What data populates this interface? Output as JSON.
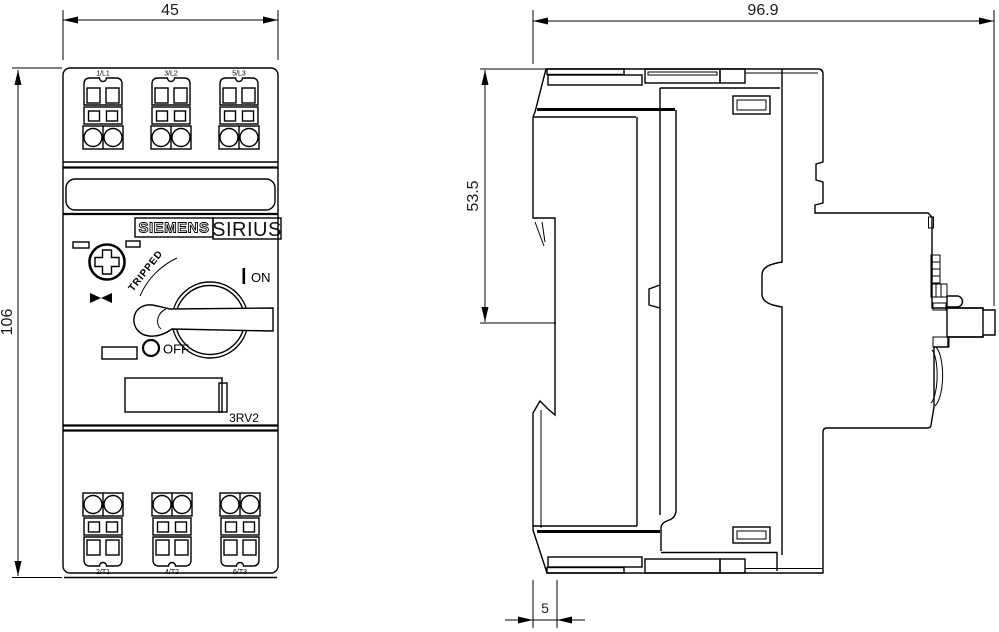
{
  "title": "Dimensional drawing motor starter protector",
  "dimensions": {
    "front_width": "45",
    "front_height": "106",
    "side_depth": "96.9",
    "side_upper": "53.5",
    "side_offset": "5"
  },
  "branding": {
    "logo": "SIEMENS",
    "series": "SIRIUS",
    "model": "3RV2"
  },
  "controls": {
    "tripped_label": "TRIPPED",
    "on_label": "ON",
    "off_label": "OFF"
  },
  "terminals": {
    "top": [
      "1/L1",
      "3/L2",
      "5/L3"
    ],
    "bottom": [
      "2/T1",
      "4/T2",
      "6/T3"
    ]
  },
  "colors": {
    "line": "#000000",
    "background": "#ffffff"
  }
}
